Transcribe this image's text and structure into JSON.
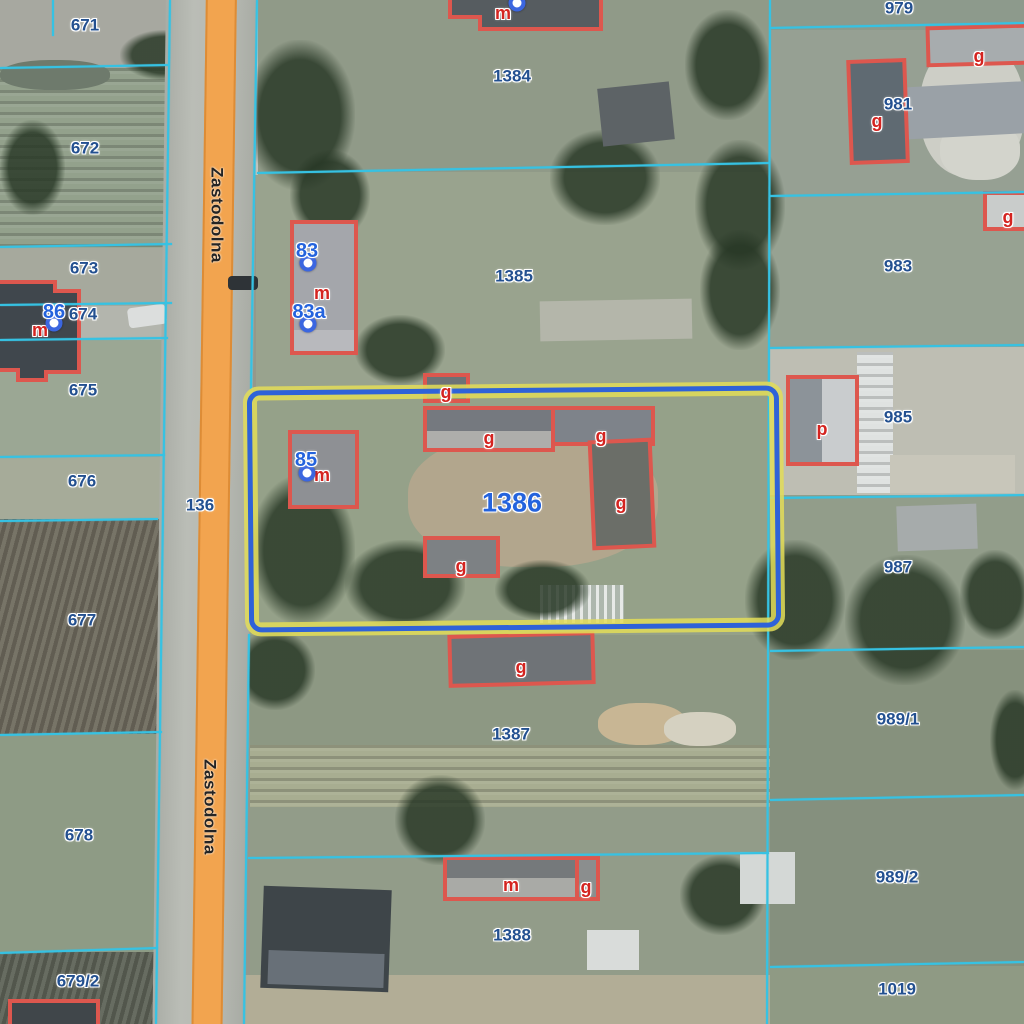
{
  "map": {
    "street": {
      "name": "Zastodolna",
      "labels": [
        {
          "x": 217,
          "y": 215
        },
        {
          "x": 210,
          "y": 807
        }
      ]
    },
    "selected_parcel": {
      "number": "1386",
      "x": 512,
      "y": 503
    },
    "parcel_labels": [
      {
        "text": "671",
        "x": 85,
        "y": 25
      },
      {
        "text": "672",
        "x": 85,
        "y": 148
      },
      {
        "text": "673",
        "x": 84,
        "y": 268
      },
      {
        "text": "674",
        "x": 83,
        "y": 314
      },
      {
        "text": "675",
        "x": 83,
        "y": 390
      },
      {
        "text": "676",
        "x": 82,
        "y": 481
      },
      {
        "text": "677",
        "x": 82,
        "y": 620
      },
      {
        "text": "678",
        "x": 79,
        "y": 835
      },
      {
        "text": "679/2",
        "x": 78,
        "y": 981
      },
      {
        "text": "136",
        "x": 200,
        "y": 505
      },
      {
        "text": "1384",
        "x": 512,
        "y": 76
      },
      {
        "text": "1385",
        "x": 514,
        "y": 276
      },
      {
        "text": "1387",
        "x": 511,
        "y": 734
      },
      {
        "text": "1388",
        "x": 512,
        "y": 935
      },
      {
        "text": "979",
        "x": 899,
        "y": 8
      },
      {
        "text": "981",
        "x": 898,
        "y": 104
      },
      {
        "text": "983",
        "x": 898,
        "y": 266
      },
      {
        "text": "985",
        "x": 898,
        "y": 417
      },
      {
        "text": "987",
        "x": 898,
        "y": 567
      },
      {
        "text": "989/1",
        "x": 898,
        "y": 719
      },
      {
        "text": "989/2",
        "x": 897,
        "y": 877
      },
      {
        "text": "1019",
        "x": 897,
        "y": 989
      }
    ],
    "building_labels": [
      {
        "text": "m",
        "x": 503,
        "y": 13
      },
      {
        "text": "g",
        "x": 979,
        "y": 56
      },
      {
        "text": "g",
        "x": 877,
        "y": 121
      },
      {
        "text": "g",
        "x": 1008,
        "y": 217
      },
      {
        "text": "m",
        "x": 322,
        "y": 293
      },
      {
        "text": "m",
        "x": 40,
        "y": 330
      },
      {
        "text": "g",
        "x": 446,
        "y": 392
      },
      {
        "text": "g",
        "x": 489,
        "y": 438
      },
      {
        "text": "g",
        "x": 601,
        "y": 436
      },
      {
        "text": "g",
        "x": 621,
        "y": 503
      },
      {
        "text": "m",
        "x": 322,
        "y": 475
      },
      {
        "text": "g",
        "x": 461,
        "y": 566
      },
      {
        "text": "g",
        "x": 521,
        "y": 667
      },
      {
        "text": "p",
        "x": 822,
        "y": 429
      },
      {
        "text": "m",
        "x": 511,
        "y": 885
      },
      {
        "text": "g",
        "x": 586,
        "y": 887
      }
    ],
    "address_points": [
      {
        "number": "86",
        "text_x": 54,
        "text_y": 312,
        "marker_x": 54,
        "marker_y": 323
      },
      {
        "number": "83",
        "text_x": 307,
        "text_y": 251,
        "marker_x": 308,
        "marker_y": 263
      },
      {
        "number": "83a",
        "text_x": 309,
        "text_y": 312,
        "marker_x": 308,
        "marker_y": 324
      },
      {
        "number": "85",
        "text_x": 306,
        "text_y": 460,
        "marker_x": 307,
        "marker_y": 473
      },
      {
        "number": "",
        "text_x": 0,
        "text_y": 0,
        "marker_x": 517,
        "marker_y": 3
      }
    ],
    "colors": {
      "parcel_line": "#36c2e3",
      "parcel_label": "#235090",
      "selected_label": "#2463dd",
      "address_label": "#2463dd",
      "address_marker": "#3b66e0",
      "building_outline": "#dd574e",
      "building_label": "#d42420",
      "road_fill": "#f2a44f",
      "road_edge": "#dd8c36",
      "highlight_outer": "#e3dd58",
      "highlight_inner": "#2f62d8",
      "street_text": "#242424"
    }
  }
}
